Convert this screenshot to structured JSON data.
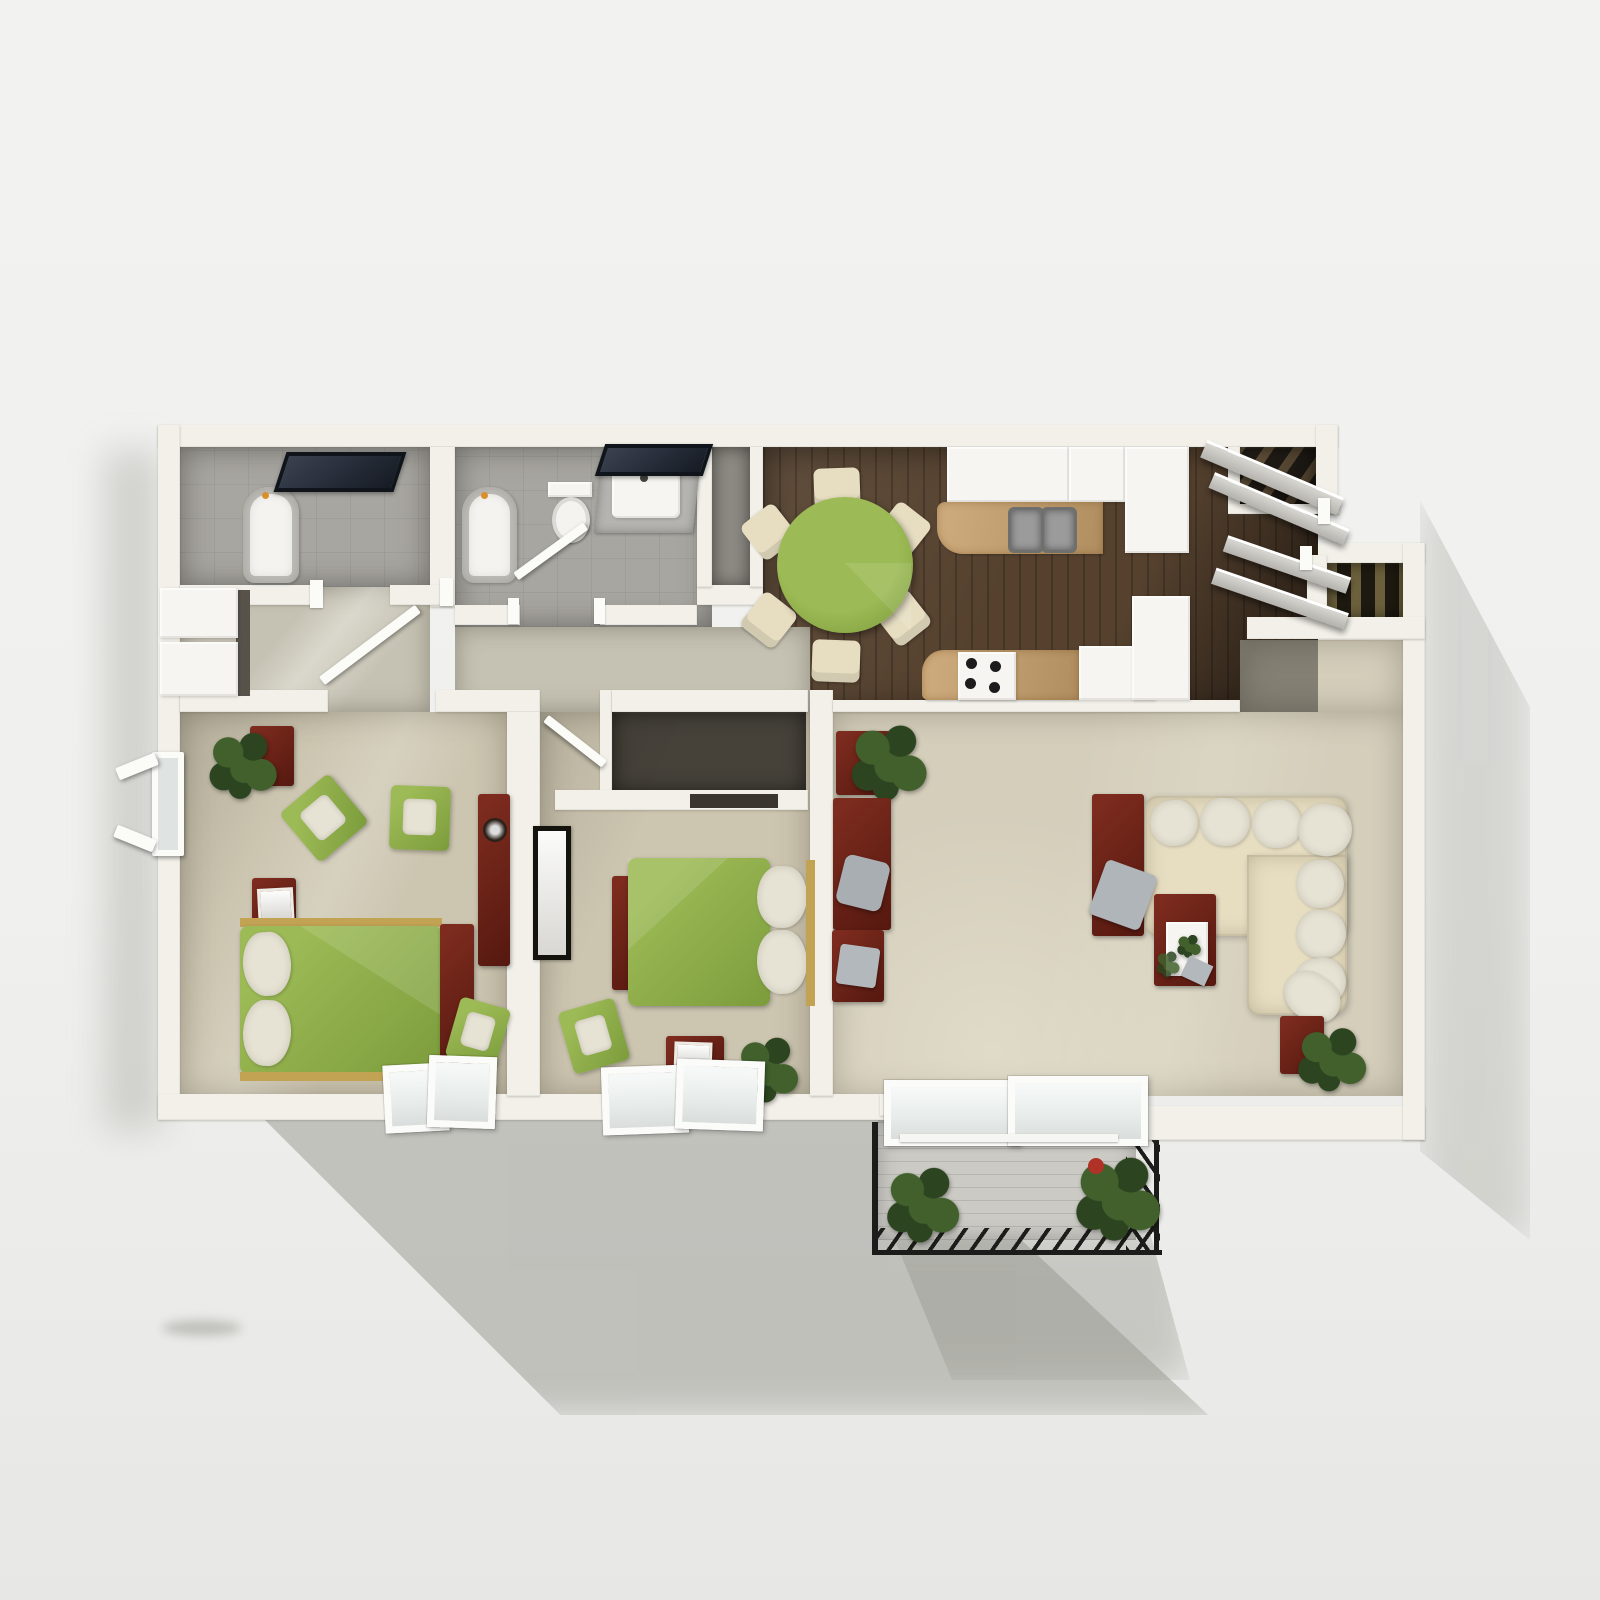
{
  "scene": {
    "type": "3d-floor-plan-rendering",
    "view": "top-down",
    "description": "Photorealistic top-down 3D rendering of a two-bedroom apartment floor plan with two bathrooms, hallway closets, galley kitchen with round dining table, living room with sectional sofa, entry staircases and a rear balcony. No text labels are rendered in the image."
  },
  "colors": {
    "background": "#f1f1f0",
    "wall": "#f2f0e9",
    "hall": "#c6c2b3",
    "carpet": "#ccc5b0",
    "carpet_light": "#d4cebb",
    "tile": "#a8a6a0",
    "tile_dark": "#8e8b84",
    "wood": "#55412e",
    "green": "#9cba55",
    "green_dark": "#7c9c3c",
    "cream": "#e7dec2",
    "pillow": "#e7e3d4",
    "red": "#7c2b1e",
    "red_dark": "#55180f",
    "navy": "#2c3442",
    "white_fixture": "#f6f5f1",
    "granite_a": "#cfac7e",
    "granite_b": "#b08e60",
    "stair_bg": "#262019",
    "stair_step": "#6f5c41",
    "stair_bg2": "#1e1a11",
    "stair_step2": "#6c603c",
    "rail": "#1c1c1a",
    "deck": "#cbcac5",
    "plant": "#41602c",
    "plant_dark": "#2c4520",
    "glass": "#e7ecea",
    "door_gray": "#c9c7c2",
    "shadow": "#97978f"
  },
  "rooms": [
    {
      "name": "bathroom-1",
      "floor": "tile",
      "items": [
        "bathtub",
        "wall-mirror",
        "shower-area"
      ]
    },
    {
      "name": "hallway-closets",
      "floor": "carpet",
      "items": [
        "closet-door",
        "closet-door",
        "open-door"
      ]
    },
    {
      "name": "bathroom-2",
      "floor": "tile",
      "items": [
        "bathtub",
        "toilet",
        "vanity-sink",
        "wall-mirror",
        "open-door"
      ]
    },
    {
      "name": "linen-closet",
      "floor": "tile",
      "items": []
    },
    {
      "name": "kitchen-dining",
      "floor": "dark-wood",
      "items": [
        "round-dining-table",
        "dining-chair",
        "dining-chair",
        "dining-chair",
        "dining-chair",
        "dining-chair",
        "dining-chair",
        "double-sink",
        "stove-four-burner",
        "refrigerator",
        "upper-cabinets",
        "granite-counter",
        "granite-counter"
      ]
    },
    {
      "name": "entry",
      "floor": "dark-wood",
      "items": [
        "staircase-upper",
        "staircase-lower",
        "open-door-panels"
      ]
    },
    {
      "name": "bedroom-1",
      "floor": "carpet",
      "items": [
        "double-bed-green",
        "pillow",
        "pillow",
        "nightstand",
        "potted-plant",
        "armchair",
        "armchair",
        "armchair",
        "desk-with-picture",
        "dresser-with-bowl",
        "footboard-bench",
        "side-window",
        "bottom-windows"
      ]
    },
    {
      "name": "bedroom-2",
      "floor": "carpet",
      "items": [
        "double-bed-green",
        "pillow",
        "pillow",
        "footboard-bench",
        "armchair",
        "desk-with-picture",
        "potted-plant",
        "framed-art",
        "closet",
        "bottom-windows"
      ]
    },
    {
      "name": "living-room",
      "floor": "carpet",
      "items": [
        "sectional-sofa",
        "sofa-pillows-x8",
        "side-console",
        "gray-throw",
        "desk-console",
        "desk-chair",
        "storage-console",
        "coffee-table-with-tray",
        "end-table-with-plant",
        "console-with-plant"
      ]
    },
    {
      "name": "balcony",
      "floor": "deck",
      "items": [
        "metal-railing",
        "potted-plant",
        "potted-plant",
        "sliding-glass-door"
      ]
    }
  ],
  "counts": {
    "bedrooms": 2,
    "bathrooms": 2,
    "dining_chairs": 6,
    "sofa_pillows": 8,
    "balcony_plants": 2,
    "staircases": 2
  }
}
